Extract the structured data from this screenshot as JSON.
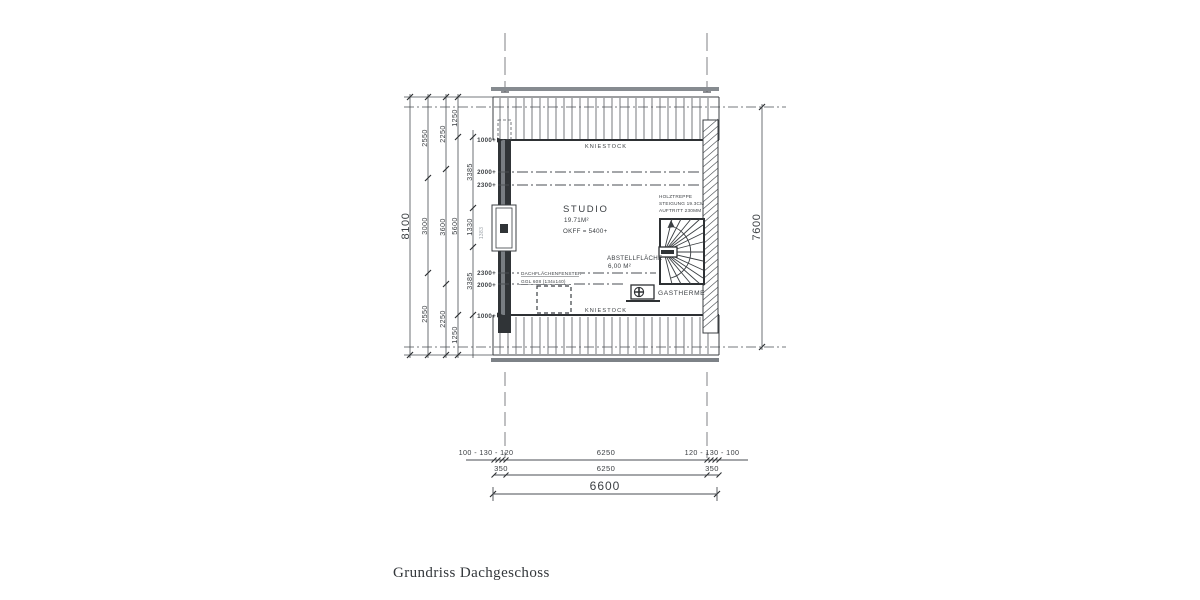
{
  "title": "Grundriss Dachgeschoss",
  "plan": {
    "kniestock_top": "KNIESTOCK",
    "kniestock_bottom": "KNIESTOCK",
    "room": {
      "name": "STUDIO",
      "area": "19.71M²",
      "floor_level": "OKFF  =  5400+"
    },
    "stair_note": {
      "line1": "HOLZTREPPE",
      "line2": "STEIGUNG  19.3CM",
      "line3": "AUFTRITT  230MM"
    },
    "storage_note": {
      "line1": "ABSTELLFLÄCHE",
      "line2": "6,00 M²"
    },
    "heater_label": "GASTHERME",
    "roof_window_note": {
      "line1": "DACHFLÄCHENFENSTER",
      "line2": "GGL 608 (134x140)"
    }
  },
  "dims": {
    "left_total": "8100",
    "chain_a": [
      "2550",
      "3000",
      "2550"
    ],
    "chain_b": [
      "2250",
      "3600",
      "2250"
    ],
    "chain_c": [
      "1250",
      "5600",
      "1250"
    ],
    "chain_d": [
      "3385",
      "1330",
      "3385"
    ],
    "chain_d_alt": "1383",
    "heights": {
      "top": [
        "1000+",
        "2000+",
        "2300+"
      ],
      "bottom": [
        "2300+",
        "2000+",
        "1000+"
      ]
    },
    "right_total": "7600",
    "bottom_row1": {
      "left": "100 - 130 - 120",
      "center": "6250",
      "right": "120 - 130 - 100"
    },
    "bottom_row2": {
      "left": "350",
      "center": "6250",
      "right": "350"
    },
    "bottom_row3": "6600"
  }
}
